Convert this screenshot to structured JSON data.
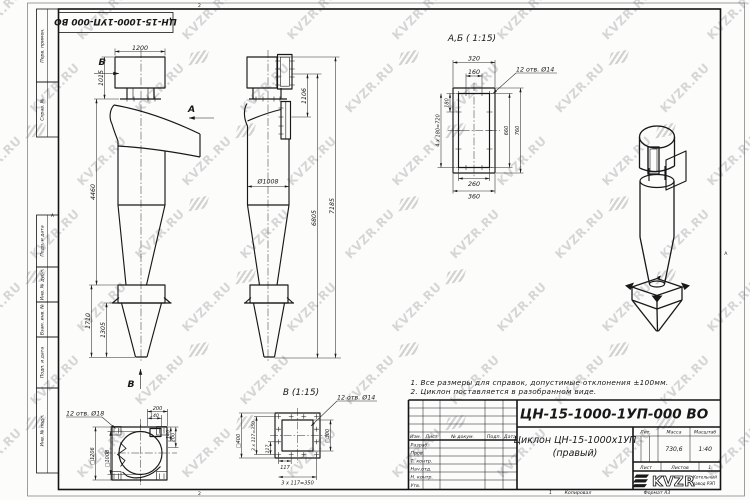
{
  "watermark": {
    "text": "KVZR.RU"
  },
  "frame": {
    "stamp": "ЦН-15-1000-1УП-000 ВО",
    "zone_top": "2",
    "zone_bottom": "2",
    "zone_left": "А",
    "zone_right": "А",
    "margin": {
      "perv": "Перв. примен.",
      "sprav": "Справ. №",
      "podp1": "Подп. и дата",
      "inv_dubl": "Инв. № дубл.",
      "vzam": "Взам. инв. №",
      "podp2": "Подп. и дата",
      "inv_podl": "Инв. № подл."
    }
  },
  "front": {
    "w": "1200",
    "inlet": "1015",
    "body": "4460",
    "cone": "1710",
    "cone2": "1305",
    "view_b": "Б",
    "view_a": "А",
    "view_v": "В"
  },
  "side": {
    "flange": "1106",
    "dia": "Ø1008",
    "h1": "6805",
    "h2": "7185"
  },
  "section": {
    "title": "А,Б ( 1:15)",
    "holes": "12 отв. Ø14",
    "d320": "320",
    "d160": "160",
    "d180": "180",
    "d720": "4 x 180=720",
    "d660": "660",
    "d760": "760",
    "d260": "260",
    "d360": "360"
  },
  "bottom": {
    "holes": "12 отв. Ø18",
    "sq1": "□1206",
    "sq2": "□1008",
    "d200t": "200",
    "d140t": "140",
    "d200r": "200",
    "d140r": "140"
  },
  "vview": {
    "title": "В (1:15)",
    "holes": "12 отв. Ø14",
    "sq1": "□400",
    "sq2": "□300",
    "row1": "3 x 117=350",
    "d117a": "117",
    "d117b": "117",
    "row2": "3 x 117=350"
  },
  "notes": {
    "n1": "1. Все размеры для справок, допустимые отклонения ±100мм.",
    "n2": "2. Циклон поставляется в разобранном виде."
  },
  "tb": {
    "doc": "ЦН-15-1000-1УП-000 ВО",
    "name1": "Циклон ЦН-15-1000х1УП",
    "name2": "(правый)",
    "h_izm": "Изм.",
    "h_list": "Лист",
    "h_doc": "№ докум.",
    "h_podp": "Подп.",
    "h_data": "Дата",
    "razrab": "Разраб.",
    "prov": "Пров.",
    "tkontr": "Т. контр.",
    "nachotd": "Нач.отд.",
    "nkontr": "Н. контр.",
    "utv": "Утв.",
    "lit": "Лит.",
    "massa": "Масса",
    "masshtab": "Масштаб",
    "massa_v": "730,6",
    "scale_v": "1:40",
    "list": "Лист",
    "listov": "Листов",
    "listov_v": "1",
    "logo": "KVZR",
    "logo_s1": "Котельный",
    "logo_s2": "завод РЭП"
  },
  "footer": {
    "n": "1",
    "copy": "Копировал",
    "fmt": "Формат А3"
  }
}
